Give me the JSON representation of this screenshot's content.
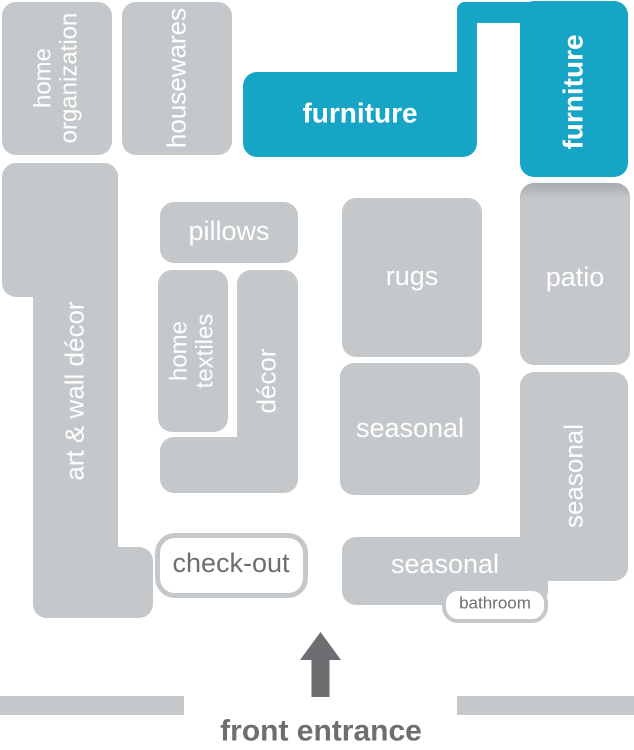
{
  "colors": {
    "block_gray": "#c5c8ca",
    "accent_blue": "#17a5c6",
    "text_light": "#ffffff",
    "text_dark": "#6d6e71",
    "background": "#ffffff"
  },
  "areas": {
    "home_organization": {
      "line1": "home",
      "line2": "organization"
    },
    "housewares": {
      "label": "housewares"
    },
    "furniture_main": {
      "label": "furniture"
    },
    "furniture_right": {
      "label": "furniture"
    },
    "art_wall_decor": {
      "label": "art & wall décor"
    },
    "pillows": {
      "label": "pillows"
    },
    "home_textiles": {
      "line1": "home",
      "line2": "textiles"
    },
    "decor": {
      "label": "décor"
    },
    "rugs": {
      "label": "rugs"
    },
    "patio": {
      "label": "patio"
    },
    "seasonal_middle": {
      "label": "seasonal"
    },
    "seasonal_right": {
      "label": "seasonal"
    },
    "seasonal_bottom": {
      "label": "seasonal"
    },
    "checkout": {
      "label": "check-out"
    },
    "bathroom": {
      "label": "bathroom"
    }
  },
  "entrance": {
    "label": "front entrance",
    "icon": "up-arrow"
  }
}
